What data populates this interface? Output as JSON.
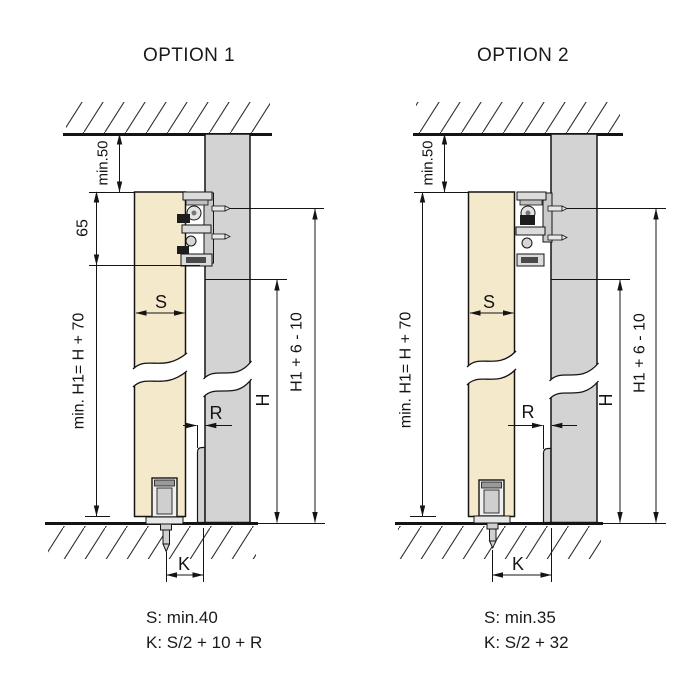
{
  "drawing": {
    "type": "sliding-door-fitting-installation-diagram",
    "colors": {
      "background": "#ffffff",
      "door_panel": "#f5e9cb",
      "wall_panel": "#d3d3d3",
      "hardware_light": "#dcdcdc",
      "hardware_dark": "#1d1d1d",
      "line": "#141414"
    }
  },
  "option1": {
    "title": "OPTION 1",
    "dims": {
      "ceiling_gap": "min.50",
      "mechanism_height": "65",
      "min_total_height": "min. H1= H + 70",
      "door_thickness": "S",
      "profile_offset": "R",
      "opening_height": "H",
      "panel_height": "H1 + 6 - 10",
      "bottom_distance": "K"
    },
    "formulas": {
      "s": "S: min.40",
      "k": "K: S/2 + 10 + R"
    }
  },
  "option2": {
    "title": "OPTION 2",
    "dims": {
      "ceiling_gap": "min.50",
      "min_total_height": "min. H1= H + 70",
      "door_thickness": "S",
      "profile_offset": "R",
      "opening_height": "H",
      "panel_height": "H1 + 6 - 10",
      "bottom_distance": "K"
    },
    "formulas": {
      "s": "S: min.35",
      "k": "K: S/2 + 32"
    }
  }
}
